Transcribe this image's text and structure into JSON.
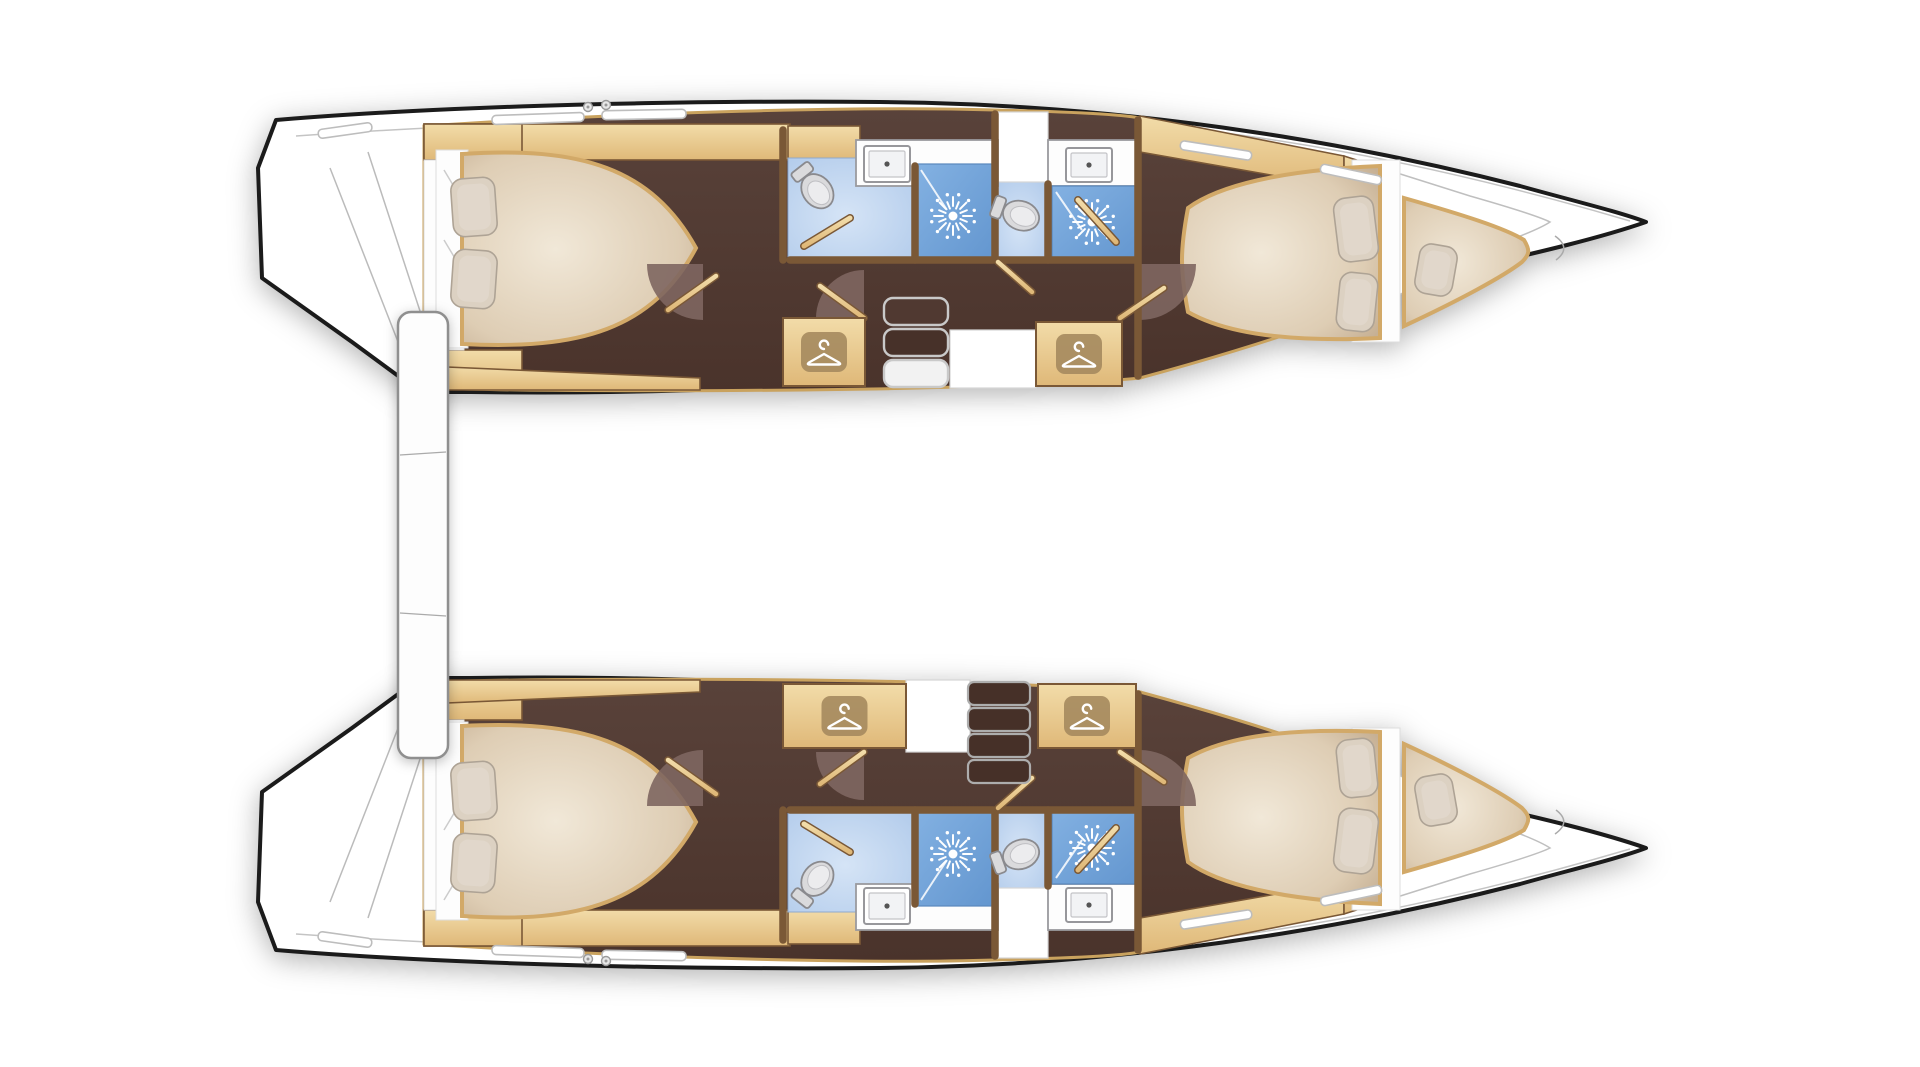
{
  "meta": {
    "title": "Catamaran two-hull interior floor plan",
    "view": "overhead deck plan",
    "visible_text": "none"
  },
  "colors": {
    "hull_outline": "#1b1b1b",
    "deck_line": "#c4c4c4",
    "wood_trim": "#c9a25e",
    "wood_light": "#f2dca9",
    "wood_deep": "#dfb878",
    "wood_dark_edge": "#7a5836",
    "floor_mid": "#59423a",
    "floor_dark": "#4a332b",
    "fan_brown": "#7e6660",
    "mattress_light": "#f1e8d8",
    "mattress_mid": "#decdb4",
    "mattress_edge": "#c6b094",
    "mattress_border": "#d2a968",
    "pillow": "#dcd1c2",
    "pillow_edge": "#aea395",
    "bath_floor_light": "#d5e4f6",
    "bath_floor": "#afc9ea",
    "shower_blue_light": "#83b1e2",
    "shower_blue": "#6396cf",
    "fixture_fill": "#dadadc",
    "fixture_stroke": "#8a8a8e",
    "fixture_inner": "#ececee",
    "counter_white": "#fdfdfd",
    "counter_stroke": "#9a9a9e",
    "icon_bg": "#a58a5e",
    "icon_glyph": "#ffffff",
    "steps_stroke": "#c9c9c9",
    "drawer_fill": "#463028",
    "crossbeam_stroke": "#8f8f8f"
  },
  "vessel": {
    "type": "catamaran",
    "hull_count": 2,
    "per_hull_rooms": [
      {
        "name": "aft-cabin",
        "features": [
          "double-berth",
          "two-pillows"
        ]
      },
      {
        "name": "aft-head",
        "features": [
          "toilet",
          "washbasin",
          "shower"
        ]
      },
      {
        "name": "companionway",
        "features": [
          "steps",
          "hanging-lockers",
          "landing"
        ]
      },
      {
        "name": "forward-head",
        "features": [
          "toilet",
          "washbasin",
          "shower"
        ]
      },
      {
        "name": "forward-cabin",
        "features": [
          "double-berth",
          "two-pillows"
        ]
      },
      {
        "name": "forepeak-berth",
        "features": [
          "single-berth",
          "pillow"
        ]
      }
    ],
    "between_hulls": [
      "aft-crossbeam-bar"
    ]
  },
  "hulls": [
    {
      "id": "top",
      "fixtures": [
        {
          "type": "floor",
          "name": "aft-head-floor",
          "x": 788,
          "y": 158,
          "w": 127,
          "h": 104
        },
        {
          "type": "floor",
          "name": "forward-head-floor",
          "x": 997,
          "y": 182,
          "w": 51,
          "h": 80
        },
        {
          "type": "landing",
          "name": "entry-landing",
          "x": 995,
          "y": 112,
          "w": 53,
          "h": 70
        },
        {
          "type": "landing",
          "name": "companionway-landing",
          "x": 950,
          "y": 330,
          "w": 86,
          "h": 58
        },
        {
          "type": "counter",
          "name": "aft-head-counter",
          "x": 856,
          "y": 140,
          "w": 142,
          "h": 46
        },
        {
          "type": "counter",
          "name": "forward-head-counter",
          "x": 1048,
          "y": 140,
          "w": 92,
          "h": 46
        },
        {
          "type": "shower",
          "name": "aft-head-shower",
          "x": 917,
          "y": 164,
          "w": 76,
          "h": 98,
          "bx": 953,
          "by": 216,
          "glass": [
            921,
            170,
            947,
            210
          ]
        },
        {
          "type": "shower",
          "name": "forward-head-shower",
          "x": 1052,
          "y": 186,
          "w": 86,
          "h": 76,
          "bx": 1092,
          "by": 222,
          "glass": [
            1056,
            192,
            1082,
            230
          ]
        },
        {
          "type": "fan",
          "name": "door-swing-aft-cabin",
          "cx": 703,
          "cy": 264,
          "r": 56,
          "a1": 90,
          "a2": 180
        },
        {
          "type": "fan",
          "name": "door-swing-companionway",
          "cx": 864,
          "cy": 318,
          "r": 48,
          "a1": 180,
          "a2": 270
        },
        {
          "type": "fan",
          "name": "door-swing-forward-cabin",
          "cx": 1140,
          "cy": 264,
          "r": 56,
          "a1": 0,
          "a2": 90
        },
        {
          "type": "wall",
          "name": "wall-aft-head-left",
          "x1": 783,
          "y1": 130,
          "x2": 783,
          "y2": 260
        },
        {
          "type": "wall",
          "name": "wall-shower-divider-aft",
          "x1": 915,
          "y1": 166,
          "x2": 915,
          "y2": 260
        },
        {
          "type": "wall",
          "name": "wall-heads-divider",
          "x1": 995,
          "y1": 114,
          "x2": 995,
          "y2": 260
        },
        {
          "type": "wall",
          "name": "wall-shower-divider-fwd",
          "x1": 1048,
          "y1": 184,
          "x2": 1048,
          "y2": 260
        },
        {
          "type": "wall",
          "name": "wall-forward-cabin",
          "x1": 1138,
          "y1": 120,
          "x2": 1138,
          "y2": 376
        },
        {
          "type": "wall",
          "name": "wall-heads-front-a",
          "x1": 790,
          "y1": 260,
          "x2": 993,
          "y2": 260
        },
        {
          "type": "wall",
          "name": "wall-heads-front-b",
          "x1": 997,
          "y1": 260,
          "x2": 1136,
          "y2": 260
        },
        {
          "type": "wall",
          "name": "wall-diagonal-aft-vestibule",
          "x1": 668,
          "y1": 310,
          "x2": 716,
          "y2": 276
        },
        {
          "type": "wall",
          "name": "wall-diagonal-companionway",
          "x1": 820,
          "y1": 286,
          "x2": 864,
          "y2": 318
        },
        {
          "type": "wall",
          "name": "wall-diagonal-entry",
          "x1": 998,
          "y1": 262,
          "x2": 1032,
          "y2": 292
        },
        {
          "type": "wall",
          "name": "wall-diagonal-fwd-vestibule",
          "x1": 1120,
          "y1": 318,
          "x2": 1164,
          "y2": 288
        },
        {
          "type": "door",
          "name": "aft-head-door",
          "x1": 804,
          "y1": 246,
          "x2": 850,
          "y2": 218
        },
        {
          "type": "door",
          "name": "forward-head-shower-door",
          "x1": 1078,
          "y1": 200,
          "x2": 1116,
          "y2": 242
        },
        {
          "type": "sink",
          "name": "aft-head-sink",
          "x": 864,
          "y": 146,
          "w": 46,
          "h": 36
        },
        {
          "type": "sink",
          "name": "forward-head-sink",
          "x": 1066,
          "y": 148,
          "w": 46,
          "h": 34
        },
        {
          "type": "toilet",
          "name": "aft-head-toilet",
          "cx": 818,
          "cy": 192,
          "rot": -38
        },
        {
          "type": "toilet",
          "name": "forward-head-toilet",
          "cx": 1022,
          "cy": 216,
          "rot": -70
        },
        {
          "type": "wardrobe",
          "name": "hanging-locker-aft",
          "x": 783,
          "y": 318,
          "w": 82,
          "h": 68
        },
        {
          "type": "wardrobe",
          "name": "hanging-locker-forward",
          "x": 1036,
          "y": 322,
          "w": 86,
          "h": 64
        },
        {
          "type": "steps",
          "name": "companionway-steps",
          "x": 884,
          "y": 298,
          "w": 64,
          "h": 27,
          "gap": 4,
          "count": 3,
          "fills": [
            "#503931",
            "#473129",
            "#f2f2f2"
          ]
        },
        {
          "type": "pillow",
          "name": "aft-berth-pillow-1",
          "cx": 474,
          "cy": 207,
          "w": 44,
          "h": 58,
          "rot": -4
        },
        {
          "type": "pillow",
          "name": "aft-berth-pillow-2",
          "cx": 474,
          "cy": 279,
          "w": 44,
          "h": 58,
          "rot": 4
        },
        {
          "type": "pillow",
          "name": "fwd-berth-pillow-1",
          "cx": 1356,
          "cy": 229,
          "w": 40,
          "h": 64,
          "rot": -7
        },
        {
          "type": "pillow",
          "name": "fwd-berth-pillow-2",
          "cx": 1357,
          "cy": 302,
          "w": 38,
          "h": 58,
          "rot": 6
        },
        {
          "type": "pillow",
          "name": "bow-berth-pillow",
          "cx": 1436,
          "cy": 270,
          "w": 38,
          "h": 50,
          "rot": 10
        }
      ]
    },
    {
      "id": "bottom",
      "fixtures": [
        {
          "type": "floor",
          "name": "aft-head-floor",
          "x": 788,
          "y": 808,
          "w": 127,
          "h": 104
        },
        {
          "type": "floor",
          "name": "forward-head-floor",
          "x": 997,
          "y": 808,
          "w": 51,
          "h": 80
        },
        {
          "type": "landing",
          "name": "entry-landing",
          "x": 995,
          "y": 888,
          "w": 53,
          "h": 70
        },
        {
          "type": "landing",
          "name": "companionway-landing",
          "x": 906,
          "y": 680,
          "w": 64,
          "h": 72
        },
        {
          "type": "counter",
          "name": "aft-head-counter",
          "x": 856,
          "y": 884,
          "w": 142,
          "h": 46
        },
        {
          "type": "counter",
          "name": "forward-head-counter",
          "x": 1048,
          "y": 884,
          "w": 92,
          "h": 46
        },
        {
          "type": "shower",
          "name": "aft-head-shower",
          "x": 917,
          "y": 808,
          "w": 76,
          "h": 98,
          "bx": 953,
          "by": 854,
          "glass": [
            921,
            900,
            947,
            860
          ]
        },
        {
          "type": "shower",
          "name": "forward-head-shower",
          "x": 1052,
          "y": 808,
          "w": 86,
          "h": 76,
          "bx": 1092,
          "by": 848,
          "glass": [
            1056,
            878,
            1082,
            840
          ]
        },
        {
          "type": "fan",
          "name": "door-swing-aft-cabin",
          "cx": 703,
          "cy": 806,
          "r": 56,
          "a1": 180,
          "a2": 270
        },
        {
          "type": "fan",
          "name": "door-swing-companionway",
          "cx": 864,
          "cy": 752,
          "r": 48,
          "a1": 90,
          "a2": 180
        },
        {
          "type": "fan",
          "name": "door-swing-forward-cabin",
          "cx": 1140,
          "cy": 806,
          "r": 56,
          "a1": 270,
          "a2": 360
        },
        {
          "type": "wall",
          "name": "wall-aft-head-left",
          "x1": 783,
          "y1": 810,
          "x2": 783,
          "y2": 940
        },
        {
          "type": "wall",
          "name": "wall-shower-divider-aft",
          "x1": 915,
          "y1": 810,
          "x2": 915,
          "y2": 904
        },
        {
          "type": "wall",
          "name": "wall-heads-divider",
          "x1": 995,
          "y1": 810,
          "x2": 995,
          "y2": 956
        },
        {
          "type": "wall",
          "name": "wall-shower-divider-fwd",
          "x1": 1048,
          "y1": 810,
          "x2": 1048,
          "y2": 886
        },
        {
          "type": "wall",
          "name": "wall-forward-cabin",
          "x1": 1138,
          "y1": 694,
          "x2": 1138,
          "y2": 950
        },
        {
          "type": "wall",
          "name": "wall-heads-front-a",
          "x1": 790,
          "y1": 810,
          "x2": 993,
          "y2": 810
        },
        {
          "type": "wall",
          "name": "wall-heads-front-b",
          "x1": 997,
          "y1": 810,
          "x2": 1136,
          "y2": 810
        },
        {
          "type": "wall",
          "name": "wall-diagonal-aft-vestibule",
          "x1": 668,
          "y1": 760,
          "x2": 716,
          "y2": 794
        },
        {
          "type": "wall",
          "name": "wall-diagonal-companionway",
          "x1": 820,
          "y1": 784,
          "x2": 864,
          "y2": 752
        },
        {
          "type": "wall",
          "name": "wall-diagonal-entry",
          "x1": 998,
          "y1": 808,
          "x2": 1032,
          "y2": 778
        },
        {
          "type": "wall",
          "name": "wall-diagonal-fwd-vestibule",
          "x1": 1120,
          "y1": 752,
          "x2": 1164,
          "y2": 782
        },
        {
          "type": "door",
          "name": "aft-head-door",
          "x1": 804,
          "y1": 824,
          "x2": 850,
          "y2": 852
        },
        {
          "type": "door",
          "name": "forward-head-shower-door",
          "x1": 1078,
          "y1": 870,
          "x2": 1116,
          "y2": 828
        },
        {
          "type": "sink",
          "name": "aft-head-sink",
          "x": 864,
          "y": 888,
          "w": 46,
          "h": 36
        },
        {
          "type": "sink",
          "name": "forward-head-sink",
          "x": 1066,
          "y": 888,
          "w": 46,
          "h": 34
        },
        {
          "type": "toilet",
          "name": "aft-head-toilet",
          "cx": 818,
          "cy": 878,
          "rot": 218
        },
        {
          "type": "toilet",
          "name": "forward-head-toilet",
          "cx": 1022,
          "cy": 854,
          "rot": 250
        },
        {
          "type": "wardrobe",
          "name": "hanging-locker-aft",
          "x": 783,
          "y": 684,
          "w": 123,
          "h": 64
        },
        {
          "type": "wardrobe",
          "name": "hanging-locker-forward",
          "x": 1038,
          "y": 684,
          "w": 98,
          "h": 64
        },
        {
          "type": "drawers",
          "name": "companionway-drawers",
          "x": 968,
          "y": 682,
          "w": 62,
          "h": 23,
          "gap": 3,
          "count": 4
        },
        {
          "type": "pillow",
          "name": "aft-berth-pillow-1",
          "cx": 474,
          "cy": 863,
          "w": 44,
          "h": 58,
          "rot": 4
        },
        {
          "type": "pillow",
          "name": "aft-berth-pillow-2",
          "cx": 474,
          "cy": 791,
          "w": 44,
          "h": 58,
          "rot": -4
        },
        {
          "type": "pillow",
          "name": "fwd-berth-pillow-1",
          "cx": 1356,
          "cy": 841,
          "w": 40,
          "h": 64,
          "rot": 7
        },
        {
          "type": "pillow",
          "name": "fwd-berth-pillow-2",
          "cx": 1357,
          "cy": 768,
          "w": 38,
          "h": 58,
          "rot": -6
        },
        {
          "type": "pillow",
          "name": "bow-berth-pillow",
          "cx": 1436,
          "cy": 800,
          "w": 38,
          "h": 50,
          "rot": -10
        }
      ]
    }
  ]
}
